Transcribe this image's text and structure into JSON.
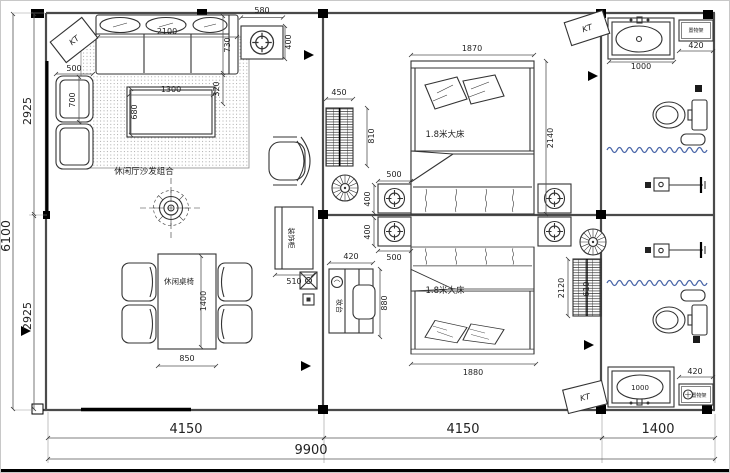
{
  "labels": {
    "sofa_area": "休闲厅沙发组合",
    "dining_set": "休闲桌椅",
    "bed_top": "1.8米大床",
    "bed_bottom": "1.8米大床",
    "deco_cabinet": "装饰柜",
    "dresser": "妆台",
    "rack_top": "置物架",
    "rack_bottom": "置物架",
    "ac1": "KT",
    "ac2": "KT",
    "ac3": "KT"
  },
  "dims": {
    "side_table_w": "580",
    "side_table_d": "400",
    "sofa_w": "2100",
    "sofa_d": "730",
    "sofa_offset": "320",
    "armchair_w": "500",
    "armchair_d": "700",
    "coffee_w": "1300",
    "coffee_d": "680",
    "left_upper": "2925",
    "left_total": "6100",
    "left_lower": "2925",
    "dining_w": "850",
    "dining_l": "1400",
    "deco_w": "510",
    "cab_w": "450",
    "cab_d": "810",
    "bed1_w": "1870",
    "bed1_l": "2140",
    "ns1_w": "500",
    "ns1_d": "400",
    "ns2_w": "500",
    "ns2_d": "400",
    "dresser_w": "420",
    "dresser_l": "880",
    "bed2_w": "1880",
    "ward_l": "2120",
    "ward_w": "610",
    "vanity1_w": "1000",
    "rack1_w": "420",
    "vanity2_w": "1000",
    "rack2_w": "420",
    "bottom_a": "4150",
    "bottom_b": "4150",
    "bottom_c": "1400",
    "bottom_total": "9900"
  },
  "colors": {
    "curtain": "#4a66a8"
  }
}
